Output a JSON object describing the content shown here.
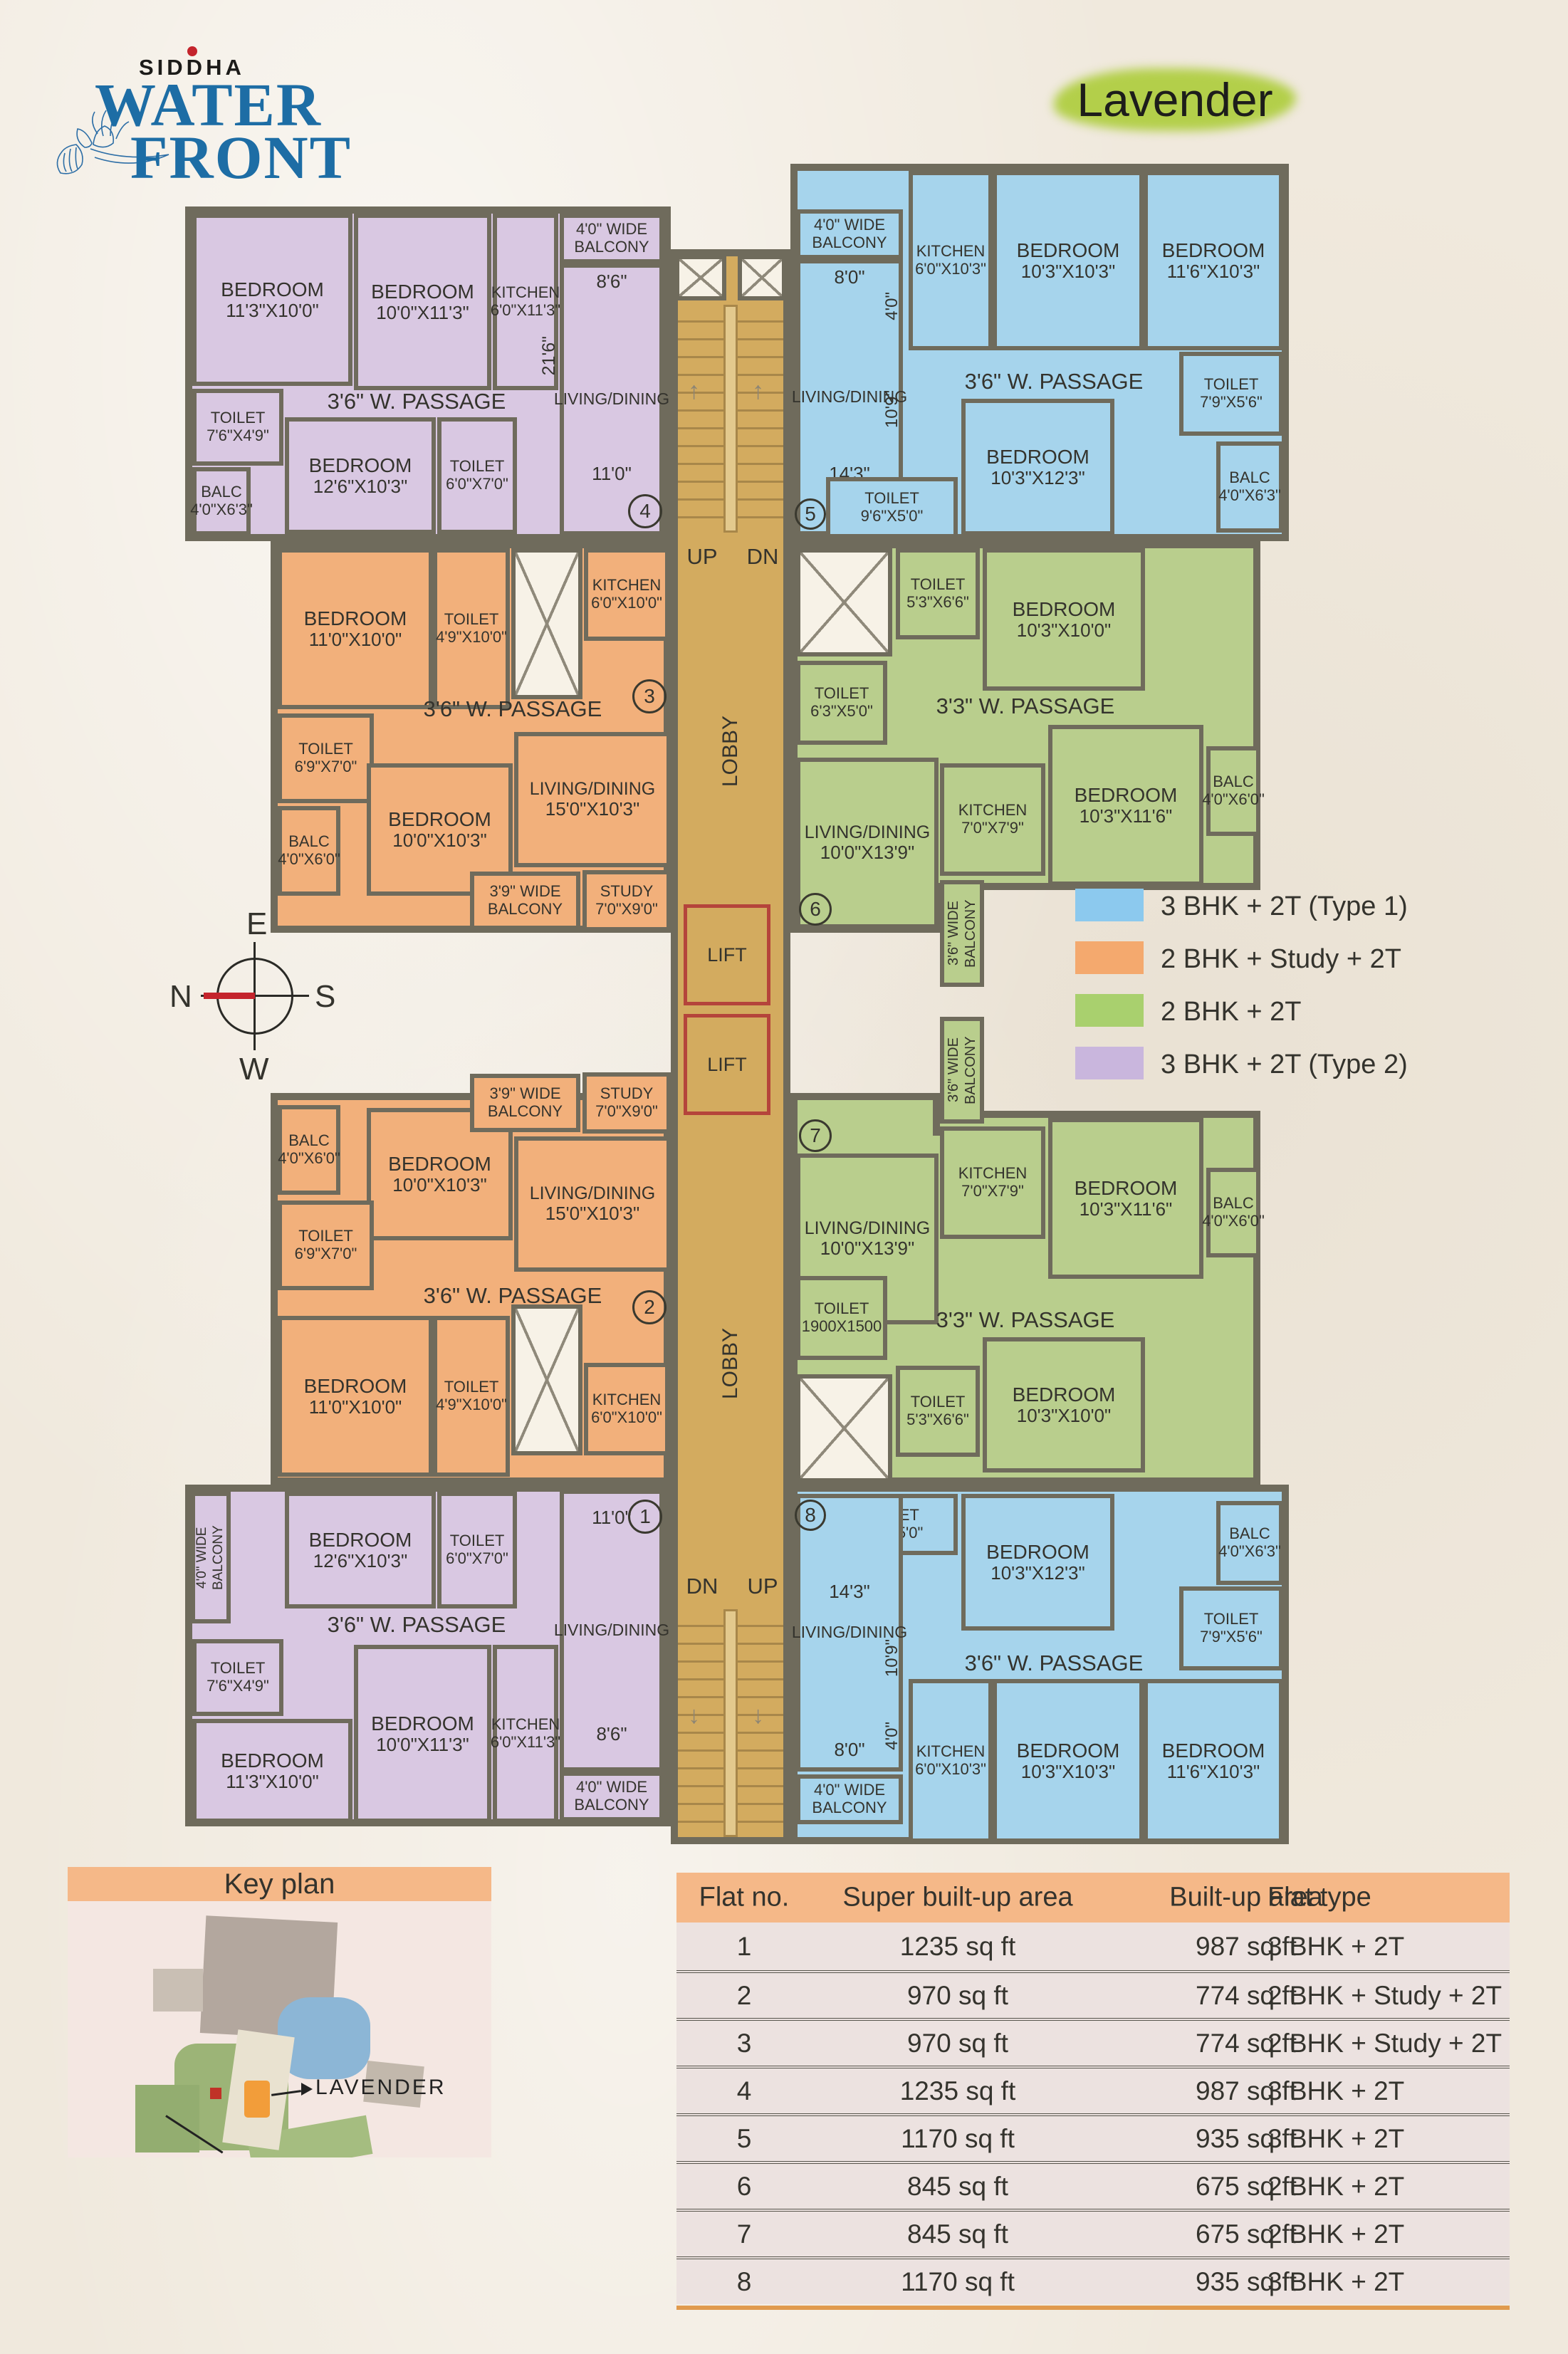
{
  "brand": {
    "siddha": "SIDDHA",
    "water": "WATER",
    "front": "FRONT"
  },
  "title": "Lavender",
  "compass": {
    "e": "E",
    "n": "N",
    "s": "S",
    "w": "W"
  },
  "core": {
    "up": "UP",
    "dn": "DN",
    "lobby": "LOBBY",
    "lift": "LIFT"
  },
  "colors": {
    "type1_blue": "#a6d4ec",
    "study_orange": "#f2b07b",
    "type2bhk_green": "#b9ce8d",
    "type2_purple": "#d9c8e2",
    "legend_blue": "#8cc9ee",
    "legend_orange": "#f4a96e",
    "legend_green": "#a9d06e",
    "legend_purple": "#c9b6dd",
    "wall": "#6f6b5c",
    "core_tan": "#d3ab5f",
    "header_orange": "#f5b888",
    "logo_blue": "#1d6da5",
    "needle_red": "#c4242c"
  },
  "legend": {
    "items": [
      {
        "label": "3 BHK + 2T (Type 1)",
        "color": "#8cc9ee"
      },
      {
        "label": "2 BHK + Study + 2T",
        "color": "#f4a96e"
      },
      {
        "label": "2 BHK + 2T",
        "color": "#a9d06e"
      },
      {
        "label": "3 BHK + 2T (Type 2)",
        "color": "#c9b6dd"
      }
    ]
  },
  "flats": {
    "f4": {
      "number": "4",
      "rooms": {
        "b1": {
          "l": "BEDROOM",
          "d": "11'3\"X10'0\""
        },
        "b2": {
          "l": "BEDROOM",
          "d": "10'0\"X11'3\""
        },
        "kit": {
          "l": "KITCHEN",
          "d": "6'0\"X11'3\""
        },
        "balcony": {
          "l": "4'0\" WIDE BALCONY"
        },
        "t1": {
          "l": "TOILET",
          "d": "7'6\"X4'9\""
        },
        "passage": {
          "l": "3'6\" W. PASSAGE"
        },
        "living": {
          "l": "LIVING/DINING"
        },
        "balc": {
          "l": "BALC",
          "d": "4'0\"X6'3\""
        },
        "b3": {
          "l": "BEDROOM",
          "d": "12'6\"X10'3\""
        },
        "t2": {
          "l": "TOILET",
          "d": "6'0\"X7'0\""
        }
      },
      "dims": {
        "a": "8'6\"",
        "b": "21'6\"",
        "c": "11'0\""
      }
    },
    "f5": {
      "number": "5",
      "rooms": {
        "balcony": {
          "l": "4'0\" WIDE BALCONY"
        },
        "kit": {
          "l": "KITCHEN",
          "d": "6'0\"X10'3\""
        },
        "b1": {
          "l": "BEDROOM",
          "d": "10'3\"X10'3\""
        },
        "b2": {
          "l": "BEDROOM",
          "d": "11'6\"X10'3\""
        },
        "t1": {
          "l": "TOILET",
          "d": "7'9\"X5'6\""
        },
        "passage": {
          "l": "3'6\" W. PASSAGE"
        },
        "living": {
          "l": "LIVING/DINING"
        },
        "b3": {
          "l": "BEDROOM",
          "d": "10'3\"X12'3\""
        },
        "balc": {
          "l": "BALC",
          "d": "4'0\"X6'3\""
        },
        "t2": {
          "l": "TOILET",
          "d": "9'6\"X5'0\""
        }
      },
      "dims": {
        "a": "8'0\"",
        "b": "4'0\"",
        "c": "10'9\"",
        "d": "14'3\""
      }
    },
    "f3": {
      "number": "3",
      "rooms": {
        "b1": {
          "l": "BEDROOM",
          "d": "11'0\"X10'0\""
        },
        "t1": {
          "l": "TOILET",
          "d": "4'9\"X10'0\""
        },
        "kit": {
          "l": "KITCHEN",
          "d": "6'0\"X10'0\""
        },
        "t2": {
          "l": "TOILET",
          "d": "6'9\"X7'0\""
        },
        "passage": {
          "l": "3'6\" W. PASSAGE"
        },
        "b2": {
          "l": "BEDROOM",
          "d": "10'0\"X10'3\""
        },
        "living": {
          "l": "LIVING/DINING",
          "d": "15'0\"X10'3\""
        },
        "balc": {
          "l": "BALC",
          "d": "4'0\"X6'0\""
        },
        "balcony": {
          "l": "3'9\" WIDE BALCONY"
        },
        "study": {
          "l": "STUDY",
          "d": "7'0\"X9'0\""
        }
      }
    },
    "f6": {
      "number": "6",
      "rooms": {
        "t1": {
          "l": "TOILET",
          "d": "5'3\"X6'6\""
        },
        "b1": {
          "l": "BEDROOM",
          "d": "10'3\"X10'0\""
        },
        "t2": {
          "l": "TOILET",
          "d": "6'3\"X5'0\""
        },
        "passage": {
          "l": "3'3\" W. PASSAGE"
        },
        "kit": {
          "l": "KITCHEN",
          "d": "7'0\"X7'9\""
        },
        "b2": {
          "l": "BEDROOM",
          "d": "10'3\"X11'6\""
        },
        "balc": {
          "l": "BALC",
          "d": "4'0\"X6'0\""
        },
        "living": {
          "l": "LIVING/DINING",
          "d": "10'0\"X13'9\""
        },
        "balcony": {
          "l": "3'6\" WIDE BALCONY"
        }
      }
    },
    "f2": {
      "number": "2",
      "rooms": {
        "balc": {
          "l": "BALC",
          "d": "4'0\"X6'0\""
        },
        "b2": {
          "l": "BEDROOM",
          "d": "10'0\"X10'3\""
        },
        "balcony": {
          "l": "3'9\" WIDE BALCONY"
        },
        "study": {
          "l": "STUDY",
          "d": "7'0\"X9'0\""
        },
        "living": {
          "l": "LIVING/DINING",
          "d": "15'0\"X10'3\""
        },
        "t2": {
          "l": "TOILET",
          "d": "6'9\"X7'0\""
        },
        "passage": {
          "l": "3'6\" W. PASSAGE"
        },
        "b1": {
          "l": "BEDROOM",
          "d": "11'0\"X10'0\""
        },
        "t1": {
          "l": "TOILET",
          "d": "4'9\"X10'0\""
        },
        "kit": {
          "l": "KITCHEN",
          "d": "6'0\"X10'0\""
        }
      }
    },
    "f7": {
      "number": "7",
      "rooms": {
        "living": {
          "l": "LIVING/DINING",
          "d": "10'0\"X13'9\""
        },
        "balcony": {
          "l": "3'6\" WIDE BALCONY"
        },
        "kit": {
          "l": "KITCHEN",
          "d": "7'0\"X7'9\""
        },
        "b2": {
          "l": "BEDROOM",
          "d": "10'3\"X11'6\""
        },
        "balc": {
          "l": "BALC",
          "d": "4'0\"X6'0\""
        },
        "t1": {
          "l": "TOILET",
          "d": "1900X1500"
        },
        "passage": {
          "l": "3'3\" W. PASSAGE"
        },
        "b1": {
          "l": "BEDROOM",
          "d": "10'3\"X10'0\""
        },
        "t2": {
          "l": "TOILET",
          "d": "5'3\"X6'6\""
        }
      }
    },
    "f1": {
      "number": "1",
      "rooms": {
        "balcony_side": {
          "l": "4'0\" WIDE BALCONY"
        },
        "b3": {
          "l": "BEDROOM",
          "d": "12'6\"X10'3\""
        },
        "t2": {
          "l": "TOILET",
          "d": "6'0\"X7'0\""
        },
        "t1": {
          "l": "TOILET",
          "d": "7'6\"X4'9\""
        },
        "passage": {
          "l": "3'6\" W. PASSAGE"
        },
        "living": {
          "l": "LIVING/DINING"
        },
        "b1": {
          "l": "BEDROOM",
          "d": "11'3\"X10'0\""
        },
        "b2": {
          "l": "BEDROOM",
          "d": "10'0\"X11'3\""
        },
        "kit": {
          "l": "KITCHEN",
          "d": "6'0\"X11'3\""
        },
        "balcony_bottom": {
          "l": "4'0\" WIDE BALCONY"
        }
      },
      "dims": {
        "a": "11'0\"",
        "b": "8'6\""
      }
    },
    "f8": {
      "number": "8",
      "rooms": {
        "t2": {
          "l": "TOILET",
          "d": "9'6\"X5'0\""
        },
        "b3": {
          "l": "BEDROOM",
          "d": "10'3\"X12'3\""
        },
        "balc": {
          "l": "BALC",
          "d": "4'0\"X6'3\""
        },
        "t1": {
          "l": "TOILET",
          "d": "7'9\"X5'6\""
        },
        "passage": {
          "l": "3'6\" W. PASSAGE"
        },
        "living": {
          "l": "LIVING/DINING"
        },
        "kit": {
          "l": "KITCHEN",
          "d": "6'0\"X10'3\""
        },
        "b1": {
          "l": "BEDROOM",
          "d": "10'3\"X10'3\""
        },
        "b2": {
          "l": "BEDROOM",
          "d": "11'6\"X10'3\""
        },
        "balcony": {
          "l": "4'0\" WIDE BALCONY"
        }
      },
      "dims": {
        "a": "14'3\"",
        "b": "10'9\"",
        "c": "4'0\"",
        "d": "8'0\""
      }
    }
  },
  "keyplan": {
    "title": "Key plan",
    "marker": "LAVENDER"
  },
  "table": {
    "headers": [
      "Flat no.",
      "Super built-up area",
      "Built-up area",
      "Flat type"
    ],
    "rows": [
      [
        "1",
        "1235 sq ft",
        "987 sq ft",
        "3 BHK + 2T"
      ],
      [
        "2",
        "970 sq ft",
        "774 sq ft",
        "2 BHK + Study + 2T"
      ],
      [
        "3",
        "970 sq ft",
        "774 sq ft",
        "2 BHK + Study + 2T"
      ],
      [
        "4",
        "1235 sq ft",
        "987 sq ft",
        "3 BHK + 2T"
      ],
      [
        "5",
        "1170 sq ft",
        "935 sq ft",
        "3 BHK + 2T"
      ],
      [
        "6",
        "845 sq ft",
        "675 sq ft",
        "2 BHK + 2T"
      ],
      [
        "7",
        "845 sq ft",
        "675 sq ft",
        "2 BHK + 2T"
      ],
      [
        "8",
        "1170 sq ft",
        "935 sq ft",
        "3 BHK + 2T"
      ]
    ]
  }
}
